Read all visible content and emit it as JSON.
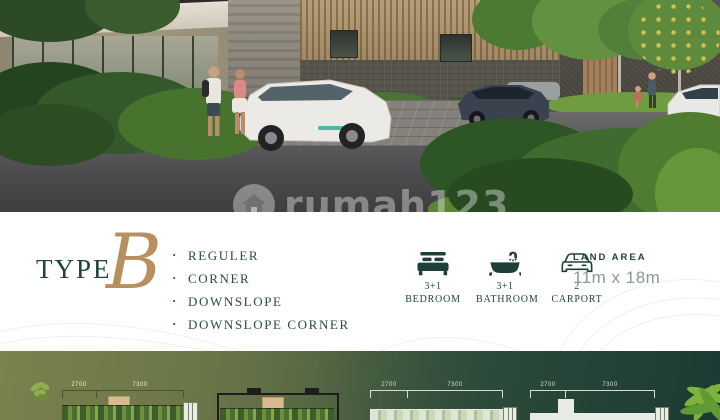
{
  "watermark": {
    "text": "rumah123",
    "icon": "house-icon"
  },
  "type_section": {
    "label": "TYPE",
    "letter": "B"
  },
  "variants": [
    "REGULER",
    "CORNER",
    "DOWNSLOPE",
    "DOWNSLOPE CORNER"
  ],
  "features": [
    {
      "icon": "bed-icon",
      "value": "3+1",
      "label": "BEDROOM"
    },
    {
      "icon": "bathtub-icon",
      "value": "3+1",
      "label": "BATHROOM"
    },
    {
      "icon": "car-icon",
      "value": "2",
      "label": "CARPORT"
    }
  ],
  "land_area": {
    "label": "LAND AREA",
    "value": "11m x 18m"
  },
  "floor_plans": {
    "plans": [
      {
        "dims": [
          "2700",
          "7300"
        ]
      },
      {
        "dims": []
      },
      {
        "dims": [
          "2700",
          "7300"
        ]
      },
      {
        "dims": [
          "2700",
          "7300"
        ]
      }
    ]
  },
  "colors": {
    "accent_gold": "#b8905f",
    "text_teal": "#23453d",
    "muted_teal": "#8a9a94",
    "strip_olive": "#76814e",
    "strip_dark_green": "#1c3a33"
  }
}
